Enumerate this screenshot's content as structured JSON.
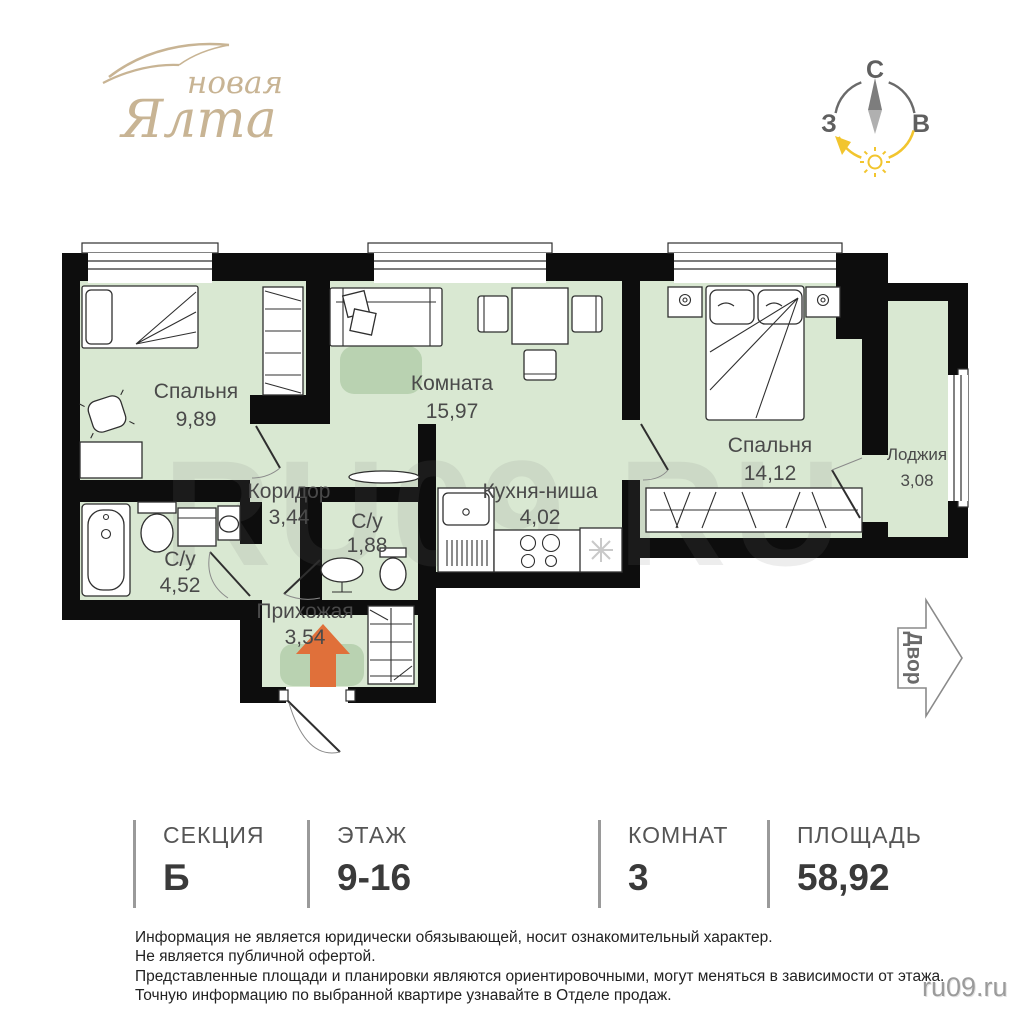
{
  "logo": {
    "word1": "новая",
    "word2": "Ялта"
  },
  "compass": {
    "north": "С",
    "west": "З",
    "east": "В"
  },
  "plan": {
    "watermark": "RU09.RU",
    "yard_label": "Двор",
    "rooms": [
      {
        "name": "Спальня",
        "area": "9,89"
      },
      {
        "name": "Комната",
        "area": "15,97"
      },
      {
        "name": "Спальня",
        "area": "14,12"
      },
      {
        "name": "Лоджия",
        "area": "3,08"
      },
      {
        "name": "Коридор",
        "area": "3,44"
      },
      {
        "name": "С/у",
        "area": "1,88"
      },
      {
        "name": "Кухня-ниша",
        "area": "4,02"
      },
      {
        "name": "С/у",
        "area": "4,52"
      },
      {
        "name": "Прихожая",
        "area": "3,54"
      }
    ]
  },
  "info": {
    "items": [
      {
        "label": "СЕКЦИЯ",
        "value": "Б"
      },
      {
        "label": "ЭТАЖ",
        "value": "9-16"
      },
      {
        "label": "КОМНАТ",
        "value": "3"
      },
      {
        "label": "ПЛОЩАДЬ",
        "value": "58,92"
      }
    ]
  },
  "disclaimer": {
    "line1": "Информация не является юридически обязывающей, носит ознакомительный характер.",
    "line2": "Не является публичной офертой.",
    "line3": "Представленные площади и планировки являются ориентировочными, могут меняться в зависимости от этажа.",
    "line4": "Точную информацию по выбранной квартире узнавайте в Отделе продаж."
  },
  "site": "ru09.ru",
  "colors": {
    "wall": "#0d0d0d",
    "room_fill": "#d9e8d2",
    "rug": "#b9d2b1",
    "arrow": "#e0703a",
    "logo": "#c8b494",
    "accent_yellow": "#f2c52e"
  }
}
